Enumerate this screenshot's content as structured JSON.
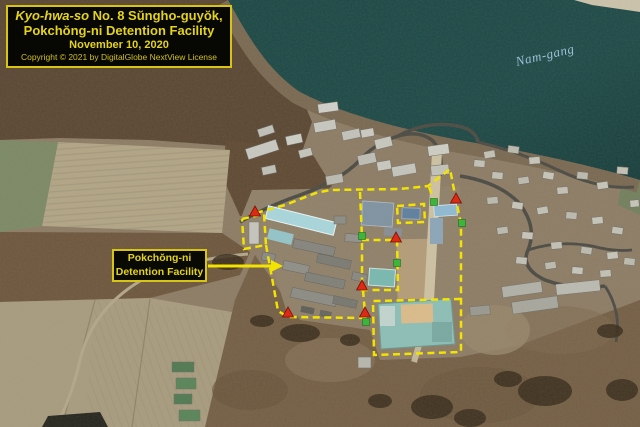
{
  "title_box": {
    "line1_italic": "Kyo-hwa-so",
    "line1_rest": " No. 8 Sŭngho-guyŏk,",
    "line2": "Pokchŏng-ni Detention Facility",
    "line3": "November 10, 2020",
    "line4": "Copyright © 2021 by DigitalGlobe NextView License"
  },
  "labels": {
    "facility_line1": "Pokchŏng-ni",
    "facility_line2": "Detention Facility",
    "river": "Nam-gang"
  },
  "colors": {
    "annotation_yellow": "#f2e300",
    "marker_red": "#de2a14",
    "marker_red_outline": "#7a1005",
    "marker_green": "#3fb43c",
    "marker_green_outline": "#1d6e1d",
    "water": "#1d4a48",
    "label_text": "#e5d31b",
    "label_border": "#d8c413"
  },
  "overlay": {
    "stroke": "#f2e300",
    "dash": "7 4.5",
    "stroke_width": 2.5,
    "paths": [
      {
        "name": "north-and-east-perimeter",
        "points": [
          [
            256,
            213
          ],
          [
            285,
            205
          ],
          [
            316,
            193
          ],
          [
            330,
            190
          ],
          [
            400,
            189
          ],
          [
            428,
            186
          ],
          [
            450,
            169
          ],
          [
            456,
            200
          ],
          [
            461,
            224
          ],
          [
            461,
            299
          ],
          [
            461,
            352
          ]
        ]
      },
      {
        "name": "southeast-compound-box",
        "points": [
          [
            461,
            299
          ],
          [
            373,
            301
          ],
          [
            374,
            355
          ],
          [
            461,
            352
          ]
        ]
      },
      {
        "name": "west-annex-box",
        "points": [
          [
            242,
            219
          ],
          [
            264,
            214
          ],
          [
            266,
            245
          ],
          [
            244,
            249
          ],
          [
            242,
            219
          ]
        ]
      },
      {
        "name": "west-and-south-perimeter",
        "points": [
          [
            266,
            245
          ],
          [
            278,
            311
          ],
          [
            288,
            317
          ],
          [
            367,
            318
          ]
        ]
      },
      {
        "name": "north-divider",
        "points": [
          [
            360,
            192
          ],
          [
            362,
            238
          ]
        ]
      },
      {
        "name": "inner-compound-box",
        "points": [
          [
            362,
            240
          ],
          [
            397,
            240
          ],
          [
            398,
            290
          ],
          [
            362,
            290
          ],
          [
            362,
            240
          ]
        ]
      },
      {
        "name": "south-divider",
        "points": [
          [
            363,
            290
          ],
          [
            366,
            325
          ]
        ]
      },
      {
        "name": "northeast-small-box",
        "points": [
          [
            397,
            206
          ],
          [
            424,
            204
          ],
          [
            425,
            222
          ],
          [
            398,
            223
          ],
          [
            397,
            206
          ]
        ]
      },
      {
        "name": "gate-stub",
        "points": [
          [
            429,
            187
          ],
          [
            434,
            201
          ]
        ]
      }
    ],
    "arrow": {
      "from": [
        208,
        266
      ],
      "to": [
        271,
        266
      ],
      "head": [
        [
          271,
          260
        ],
        [
          283,
          266
        ],
        [
          271,
          272
        ]
      ]
    },
    "red_triangles": [
      [
        255,
        212
      ],
      [
        396,
        238
      ],
      [
        456,
        199
      ],
      [
        362,
        286
      ],
      [
        288,
        313
      ],
      [
        365,
        313
      ]
    ],
    "green_squares": [
      [
        434,
        202
      ],
      [
        462,
        223
      ],
      [
        362,
        236
      ],
      [
        397,
        263
      ],
      [
        366,
        322
      ]
    ]
  }
}
